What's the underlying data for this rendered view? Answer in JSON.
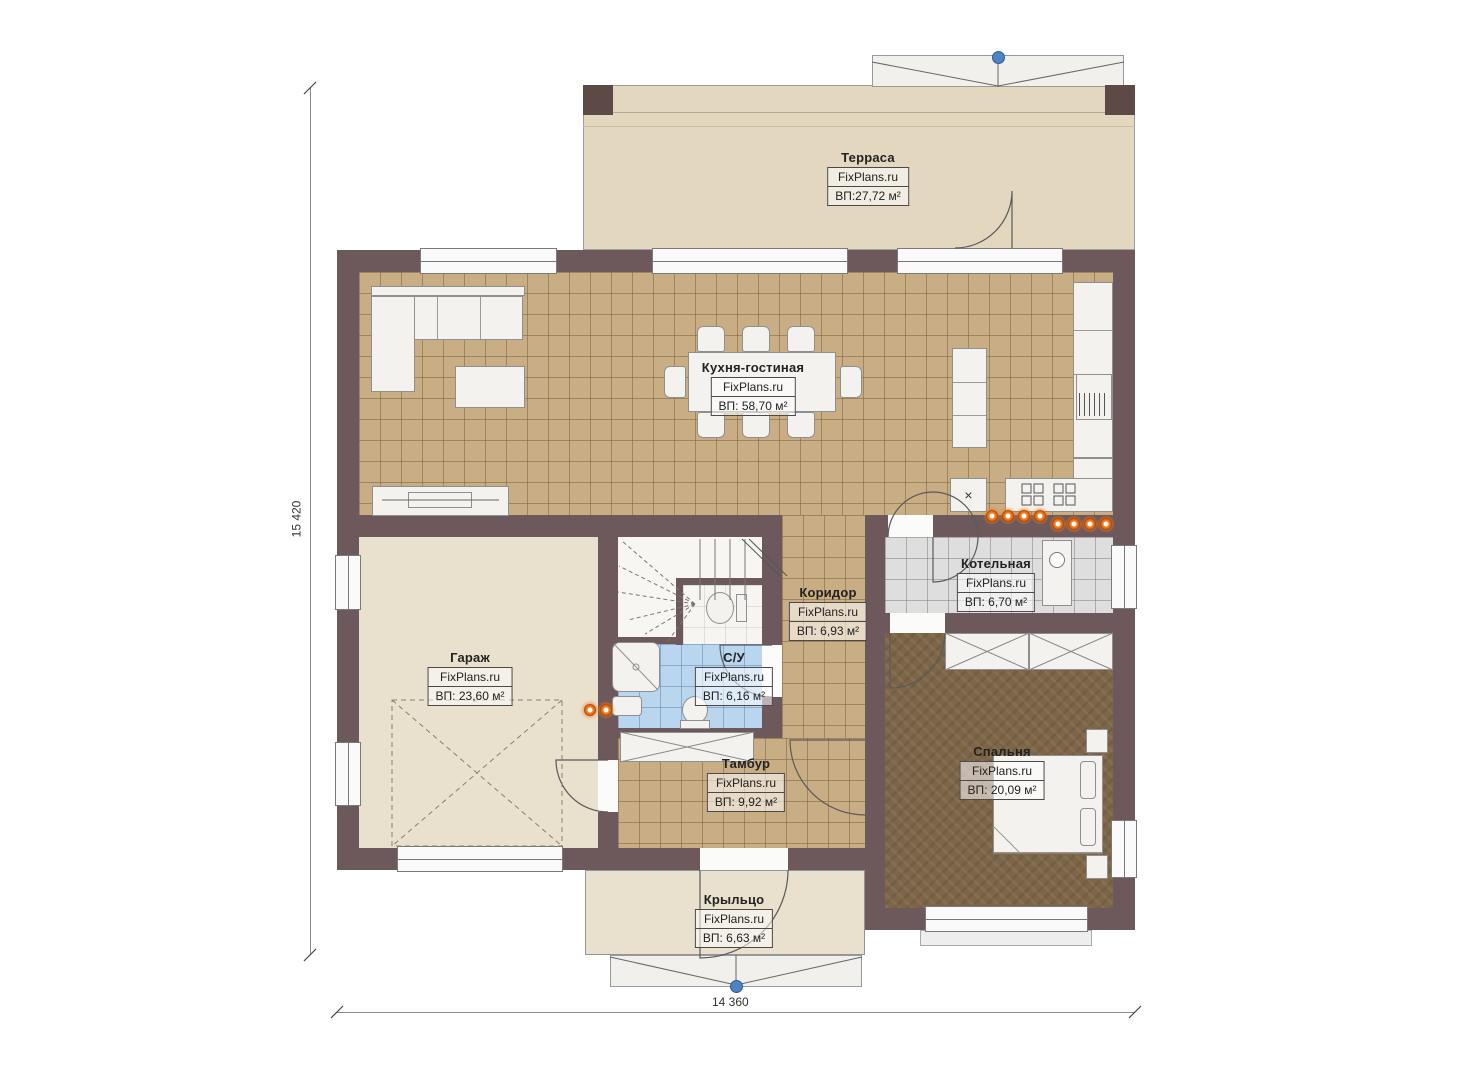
{
  "plan": {
    "dimensions": {
      "height_label": "15 420",
      "width_label": "14 360"
    },
    "rooms": [
      {
        "name": "Терраса",
        "watermark": "FixPlans.ru",
        "area": "ВП:27,72 м²"
      },
      {
        "name": "Кухня-гостиная",
        "watermark": "FixPlans.ru",
        "area": "ВП: 58,70 м²"
      },
      {
        "name": "Гараж",
        "watermark": "FixPlans.ru",
        "area": "ВП: 23,60 м²"
      },
      {
        "name": "Коридор",
        "watermark": "FixPlans.ru",
        "area": "ВП: 6,93 м²"
      },
      {
        "name": "Котельная",
        "watermark": "FixPlans.ru",
        "area": "ВП: 6,70 м²"
      },
      {
        "name": "С/У",
        "watermark": "FixPlans.ru",
        "area": "ВП: 6,16 м²"
      },
      {
        "name": "Тамбур",
        "watermark": "FixPlans.ru",
        "area": "ВП: 9,92 м²"
      },
      {
        "name": "Спальня",
        "watermark": "FixPlans.ru",
        "area": "ВП: 20,09 м²"
      },
      {
        "name": "Крыльцо",
        "watermark": "FixPlans.ru",
        "area": "ВП: 6,63 м²"
      }
    ],
    "glyphs": {
      "sink_cross": "×"
    },
    "colors": {
      "wall": "#6d585b",
      "kitchen_tile": "#c9ad84",
      "bath_tile": "#b9d6ee",
      "boiler_tile": "#dedede",
      "bedroom_carpet": "#7d6547",
      "terrace_floor": "#e3d7c0",
      "plain_floor": "#e9e0cd",
      "accent_orange": "#f07818",
      "marker_blue": "#4f83c2"
    }
  }
}
